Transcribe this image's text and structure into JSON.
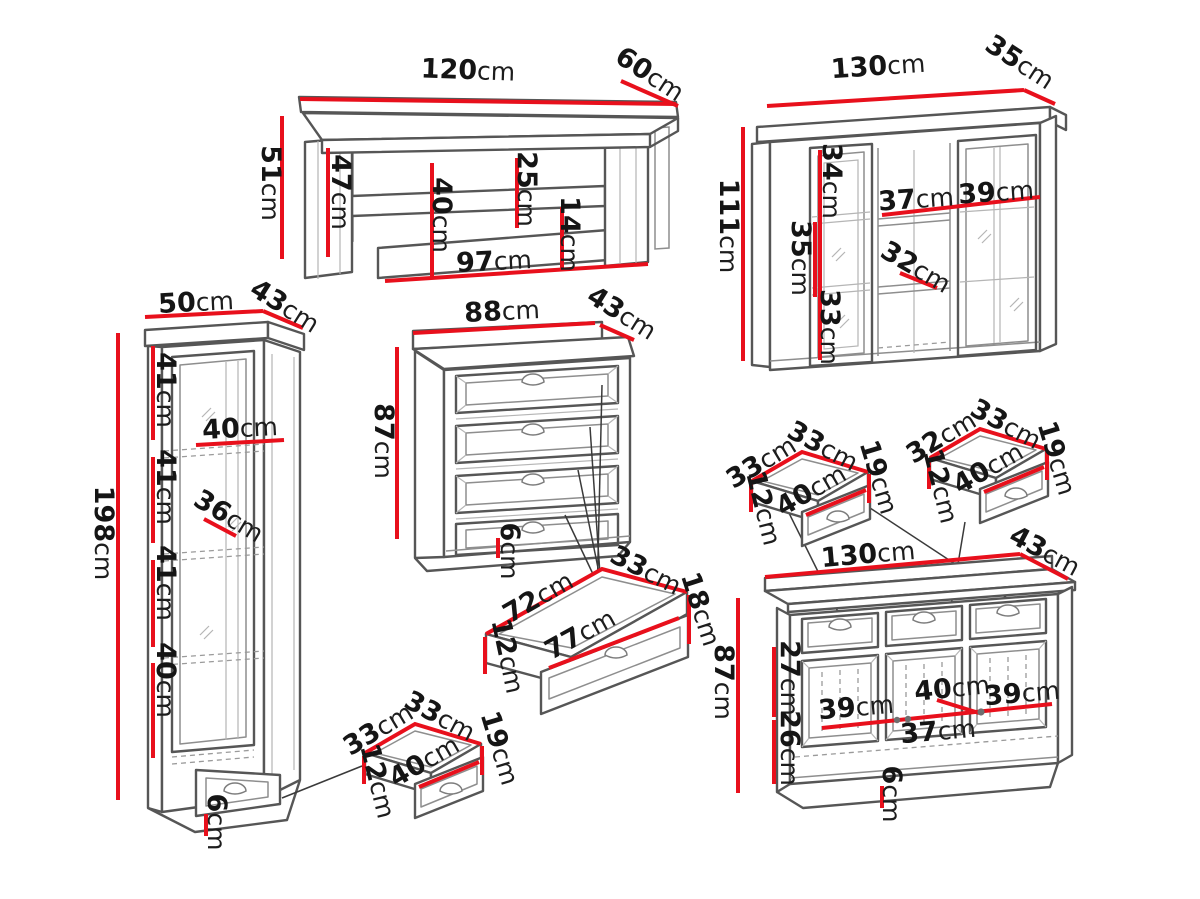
{
  "description": "Furniture set technical dimension diagram",
  "unit": "cm",
  "colors": {
    "dimension_line": "#e8101c",
    "sketch_outline": "#565656",
    "sketch_inner": "#8e8e8e",
    "label_text": "#151515",
    "background": "#ffffff"
  },
  "furniture": {
    "coffee_table": {
      "name": "coffee table",
      "dims": {
        "width": {
          "v": "120",
          "u": "cm"
        },
        "depth": {
          "v": "60",
          "u": "cm"
        },
        "height": {
          "v": "51",
          "u": "cm"
        },
        "inner_height": {
          "v": "47",
          "u": "cm"
        },
        "shelf_clearance": {
          "v": "40",
          "u": "cm"
        },
        "top_to_shelf": {
          "v": "25",
          "u": "cm"
        },
        "shelf_gap": {
          "v": "14",
          "u": "cm"
        },
        "inner_width": {
          "v": "97",
          "u": "cm"
        }
      }
    },
    "wall_cabinet": {
      "name": "wall display cabinet",
      "dims": {
        "width": {
          "v": "130",
          "u": "cm"
        },
        "depth": {
          "v": "35",
          "u": "cm"
        },
        "height": {
          "v": "111",
          "u": "cm"
        },
        "top_section": {
          "v": "34",
          "u": "cm"
        },
        "middle_section": {
          "v": "35",
          "u": "cm"
        },
        "bottom_section": {
          "v": "33",
          "u": "cm"
        },
        "left_width": {
          "v": "37",
          "u": "cm"
        },
        "right_width": {
          "v": "39",
          "u": "cm"
        },
        "inner_depth": {
          "v": "32",
          "u": "cm"
        }
      }
    },
    "tall_cabinet": {
      "name": "tall display cabinet",
      "dims": {
        "width": {
          "v": "50",
          "u": "cm"
        },
        "depth": {
          "v": "43",
          "u": "cm"
        },
        "height": {
          "v": "198",
          "u": "cm"
        },
        "section1": {
          "v": "41",
          "u": "cm"
        },
        "section2": {
          "v": "41",
          "u": "cm"
        },
        "section3": {
          "v": "41",
          "u": "cm"
        },
        "section4": {
          "v": "40",
          "u": "cm"
        },
        "inner_width": {
          "v": "40",
          "u": "cm"
        },
        "inner_depth": {
          "v": "36",
          "u": "cm"
        },
        "plinth": {
          "v": "6",
          "u": "cm"
        }
      }
    },
    "chest": {
      "name": "chest of drawers",
      "dims": {
        "width": {
          "v": "88",
          "u": "cm"
        },
        "depth": {
          "v": "43",
          "u": "cm"
        },
        "height": {
          "v": "87",
          "u": "cm"
        },
        "plinth": {
          "v": "6",
          "u": "cm"
        }
      }
    },
    "chest_drawer": {
      "name": "pulled out chest drawer",
      "dims": {
        "inner_length": {
          "v": "72",
          "u": "cm"
        },
        "depth": {
          "v": "33",
          "u": "cm"
        },
        "height": {
          "v": "18",
          "u": "cm"
        },
        "inner_height": {
          "v": "12",
          "u": "cm"
        },
        "front_length": {
          "v": "77",
          "u": "cm"
        }
      }
    },
    "drawer_left": {
      "name": "sideboard drawer left",
      "dims": {
        "length": {
          "v": "33",
          "u": "cm"
        },
        "depth": {
          "v": "33",
          "u": "cm"
        },
        "height": {
          "v": "19",
          "u": "cm"
        },
        "inner_height": {
          "v": "12",
          "u": "cm"
        },
        "front_width": {
          "v": "40",
          "u": "cm"
        }
      }
    },
    "drawer_right": {
      "name": "sideboard drawer right",
      "dims": {
        "length": {
          "v": "32",
          "u": "cm"
        },
        "depth": {
          "v": "33",
          "u": "cm"
        },
        "height": {
          "v": "19",
          "u": "cm"
        },
        "inner_height": {
          "v": "12",
          "u": "cm"
        },
        "front_width": {
          "v": "40",
          "u": "cm"
        }
      }
    },
    "drawer_bottom": {
      "name": "tall cabinet drawer",
      "dims": {
        "length": {
          "v": "33",
          "u": "cm"
        },
        "depth": {
          "v": "33",
          "u": "cm"
        },
        "height": {
          "v": "19",
          "u": "cm"
        },
        "inner_height": {
          "v": "12",
          "u": "cm"
        },
        "front_width": {
          "v": "40",
          "u": "cm"
        }
      }
    },
    "sideboard": {
      "name": "sideboard",
      "dims": {
        "width": {
          "v": "130",
          "u": "cm"
        },
        "depth": {
          "v": "43",
          "u": "cm"
        },
        "height": {
          "v": "87",
          "u": "cm"
        },
        "upper_section": {
          "v": "27",
          "u": "cm"
        },
        "lower_section": {
          "v": "26",
          "u": "cm"
        },
        "left_door_width": {
          "v": "39",
          "u": "cm"
        },
        "middle_top_width": {
          "v": "40",
          "u": "cm"
        },
        "right_door_width": {
          "v": "39",
          "u": "cm"
        },
        "middle_bottom_width": {
          "v": "37",
          "u": "cm"
        },
        "plinth": {
          "v": "6",
          "u": "cm"
        }
      }
    }
  }
}
